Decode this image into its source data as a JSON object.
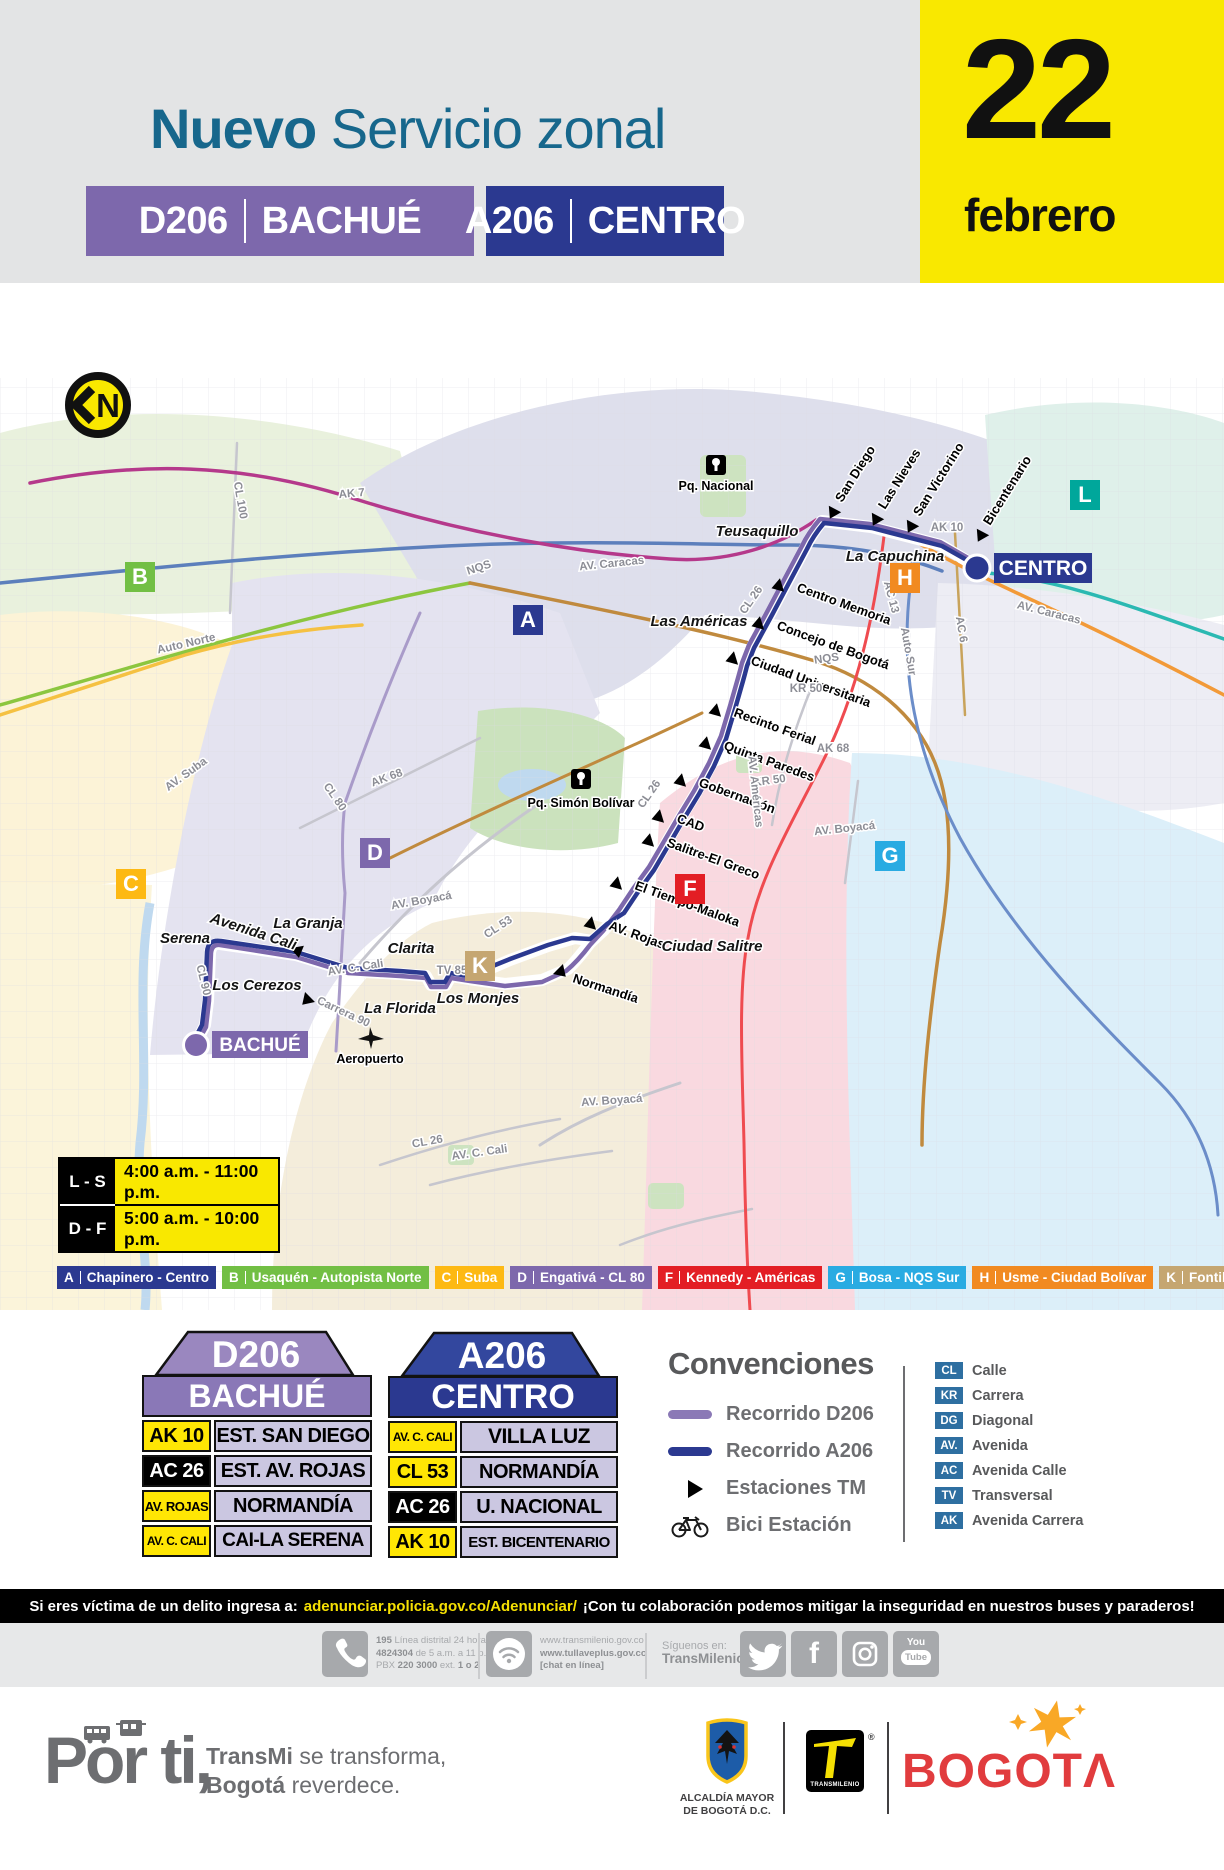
{
  "header": {
    "title_accent": "Nuevo",
    "title_rest": "Servicio zonal",
    "badges": [
      {
        "code": "D206",
        "name": "BACHUÉ",
        "color": "#7D68AC"
      },
      {
        "code": "A206",
        "name": "CENTRO",
        "color": "#2B3990"
      }
    ],
    "date": {
      "day": "22",
      "month": "febrero"
    }
  },
  "map": {
    "compass_letter": "N",
    "zones": [
      {
        "letter": "B",
        "color": "#72BF44"
      },
      {
        "letter": "A",
        "color": "#2B3990"
      },
      {
        "letter": "L",
        "color": "#00A79B"
      },
      {
        "letter": "H",
        "color": "#F18A21"
      },
      {
        "letter": "C",
        "color": "#FDB913"
      },
      {
        "letter": "D",
        "color": "#7D68AC"
      },
      {
        "letter": "G",
        "color": "#29ABE2"
      },
      {
        "letter": "F",
        "color": "#E31E24"
      },
      {
        "letter": "K",
        "color": "#C5A671"
      }
    ],
    "roads": [
      "AK 7",
      "AV. Caracas",
      "CL 100",
      "Auto Norte",
      "AV. Suba",
      "AK 68",
      "CL 80",
      "AV. Boyacá",
      "NQS",
      "NQS",
      "KR 50",
      "KR 50",
      "AK 68",
      "AV. Boyacá",
      "Auto Sur",
      "AV. Américas",
      "AC 13",
      "AC 6",
      "AV. Caracas",
      "AK 10",
      "CL 26",
      "CL 26",
      "CL 53",
      "TV 85",
      "AV. C. Cali",
      "CL 90",
      "Carrera 90",
      "AV. Boyacá",
      "CL 26",
      "AV. C. Cali"
    ],
    "areas": [
      "Teusaquillo",
      "La Capuchina",
      "Las Américas",
      "Ciudad Salitre",
      "Serena",
      "Avenida Cali",
      "La Granja",
      "Clarita",
      "Los Cerezos",
      "La Florida",
      "Los Monjes"
    ],
    "stations_ak10": [
      "San Diego",
      "Las Nieves",
      "San Victorino",
      "Bicentenario"
    ],
    "stations_cl26": [
      "Centro Memoria",
      "Concejo de Bogotá",
      "Ciudad Universitaria",
      "Recinto Ferial",
      "Quinta Paredes",
      "Gobernación",
      "CAD",
      "Salitre-El Greco",
      "El Tiempo-Maloka",
      "AV. Rojas",
      "Normandía"
    ],
    "pois": [
      "Pq. Nacional",
      "Pq. Simón Bolívar",
      "Aeropuerto"
    ],
    "terminals": [
      {
        "name": "BACHUÉ",
        "color": "#7D68AC"
      },
      {
        "name": "CENTRO",
        "color": "#2B3990"
      }
    ],
    "route_colors": {
      "d206": "#7D68AC",
      "a206": "#2B3990"
    },
    "schedule": [
      {
        "days": "L - S",
        "hours": "4:00 a.m. - 11:00 p.m."
      },
      {
        "days": "D - F",
        "hours": "5:00 a.m. - 10:00 p.m."
      }
    ],
    "zone_legend": [
      {
        "letter": "A",
        "name": "Chapinero - Centro",
        "color": "#2B3990"
      },
      {
        "letter": "B",
        "name": "Usaquén - Autopista Norte",
        "color": "#72BF44"
      },
      {
        "letter": "C",
        "name": "Suba",
        "color": "#FDB913"
      },
      {
        "letter": "D",
        "name": "Engativá - CL 80",
        "color": "#7D68AC"
      },
      {
        "letter": "F",
        "name": "Kennedy - Américas",
        "color": "#E31E24"
      },
      {
        "letter": "G",
        "name": "Bosa - NQS Sur",
        "color": "#29ABE2"
      },
      {
        "letter": "H",
        "name": "Usme - Ciudad Bolívar",
        "color": "#F18A21"
      },
      {
        "letter": "K",
        "name": "Fontibón - CL 26",
        "color": "#C5A671"
      },
      {
        "letter": "L",
        "name": "San Cristóbal - KR 10",
        "color": "#00A79B"
      }
    ]
  },
  "cards": [
    {
      "code": "D206",
      "terminal": "BACHUÉ",
      "stops": [
        {
          "via": "AK 10",
          "stop": "EST. SAN DIEGO"
        },
        {
          "via": "AC 26",
          "stop": "EST. AV. ROJAS"
        },
        {
          "via": "AV. ROJAS",
          "stop": "NORMANDÍA"
        },
        {
          "via": "AV. C. CALI",
          "stop": "CAI-LA SERENA"
        }
      ]
    },
    {
      "code": "A206",
      "terminal": "CENTRO",
      "stops": [
        {
          "via": "AV. C. CALI",
          "stop": "VILLA LUZ"
        },
        {
          "via": "CL 53",
          "stop": "NORMANDÍA"
        },
        {
          "via": "AC 26",
          "stop": "U. NACIONAL"
        },
        {
          "via": "AK 10",
          "stop": "EST. BICENTENARIO"
        }
      ]
    }
  ],
  "legend": {
    "title": "Convenciones",
    "items": [
      {
        "label": "Recorrido D206"
      },
      {
        "label": "Recorrido A206"
      },
      {
        "label": "Estaciones TM"
      },
      {
        "label": "Bici Estación"
      }
    ]
  },
  "abbreviations": [
    {
      "abbr": "CL",
      "name": "Calle"
    },
    {
      "abbr": "KR",
      "name": "Carrera"
    },
    {
      "abbr": "DG",
      "name": "Diagonal"
    },
    {
      "abbr": "AV.",
      "name": "Avenida"
    },
    {
      "abbr": "AC",
      "name": "Avenida Calle"
    },
    {
      "abbr": "TV",
      "name": "Transversal"
    },
    {
      "abbr": "AK",
      "name": "Avenida Carrera"
    }
  ],
  "alert": {
    "prefix": "Si eres víctima de un delito ingresa a:",
    "link": "adenunciar.policia.gov.co/Adenunciar/",
    "suffix": "¡Con tu colaboración podemos mitigar la inseguridad en nuestros buses y paraderos!"
  },
  "contact": {
    "phone_b1": "195",
    "phone_r1": "Línea distrital 24 horas",
    "phone_b2": "4824304",
    "phone_r2": "de 5 a.m. a 11 p.m.",
    "phone_r3a": "PBX",
    "phone_b3": "220 3000",
    "phone_r3b": "ext.",
    "phone_b4": "1 o 2",
    "web1": "www.transmilenio.gov.co",
    "web2": "www.tullaveplus.gov.co",
    "web3": "[chat en línea]",
    "follow1": "Síguenos en:",
    "follow2": "TransMilenio",
    "youtube1": "You",
    "youtube2": "Tube"
  },
  "footer": {
    "por_ti": "Por ti,",
    "tag_b1": "TransMi",
    "tag_r1": "se transforma,",
    "tag_b2": "Bogotá",
    "tag_r2": "reverdece.",
    "alcaldia1": "ALCALDÍA MAYOR",
    "alcaldia2": "DE BOGOTÁ D.C.",
    "transmilenio": "TRANSMILENIO",
    "reg": "®",
    "bogota": "BOGOT",
    "bogota_last": "Λ"
  }
}
